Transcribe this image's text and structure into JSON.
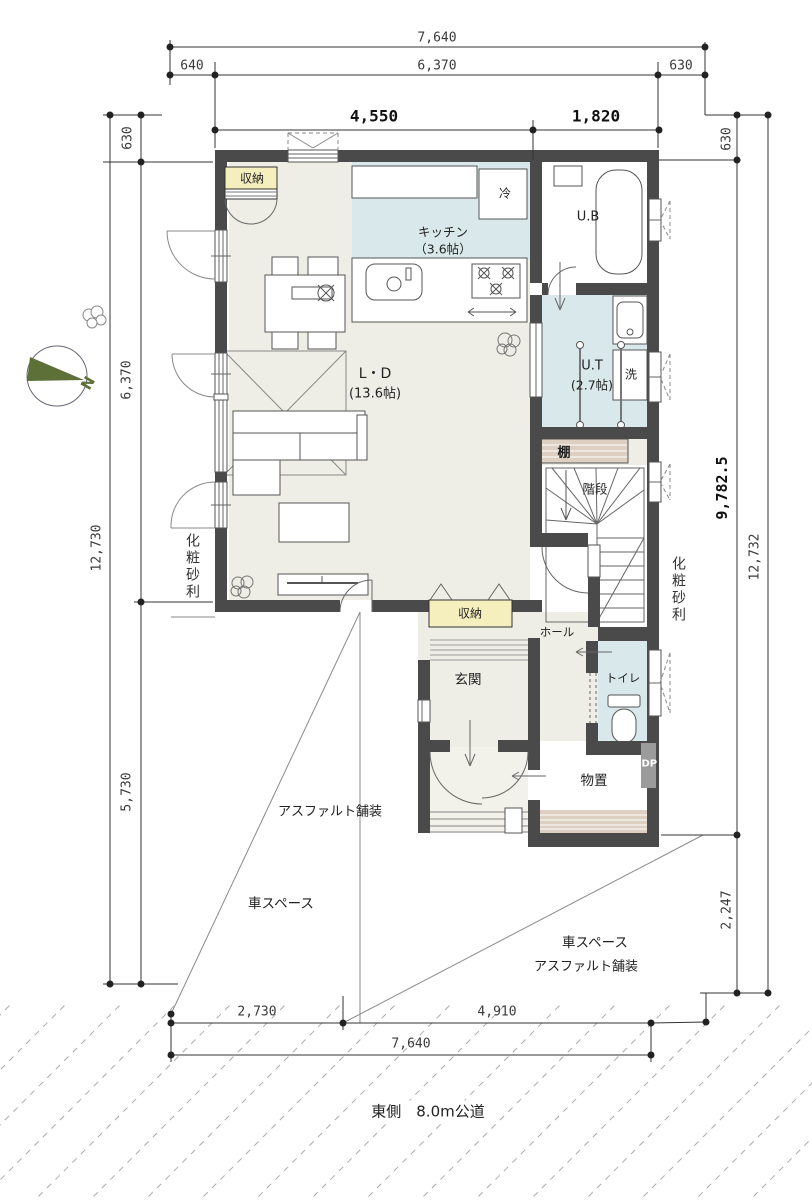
{
  "dims": {
    "top_total": "7,640",
    "top_left": "640",
    "top_mid": "6,370",
    "top_right": "630",
    "top_b_left": "4,550",
    "top_b_right": "1,820",
    "left_top": "630",
    "left_mid": "6,370",
    "left_bottom": "5,730",
    "left_total": "12,730",
    "right_top": "630",
    "right_mid": "9,782.5",
    "right_bottom": "2,247",
    "right_total": "12,732",
    "bottom_left": "2,730",
    "bottom_right": "4,910",
    "bottom_total": "7,640"
  },
  "rooms": {
    "closet_top": "収納",
    "fridge": "冷",
    "kitchen_name": "キッチン",
    "kitchen_size": "（3.6帖）",
    "ub": "U.B",
    "ut_name": "U.T",
    "ut_size": "(2.7帖)",
    "washer": "洗",
    "shelf": "棚",
    "stairs": "階段",
    "ld_name": "L・D",
    "ld_size": "(13.6帖)",
    "closet_hall": "収納",
    "hall": "ホール",
    "entrance": "玄関",
    "toilet": "トイレ",
    "shed": "物置",
    "dp": "DP"
  },
  "site": {
    "gravel_left": "化粧砂利",
    "gravel_right": "化粧砂利",
    "asphalt_left": "アスファルト舗装",
    "car_left": "車スペース",
    "car_right": "車スペース",
    "asphalt_right": "アスファルト舗装",
    "road": "東側　8.0m公道",
    "north": "N"
  },
  "colors": {
    "wall": "#4a4a4a",
    "floor": "#efeee6",
    "water": "#d9e8ea",
    "closet": "#f5efbe",
    "shelf": "#ddcfc1",
    "compass": "#5c7038"
  }
}
